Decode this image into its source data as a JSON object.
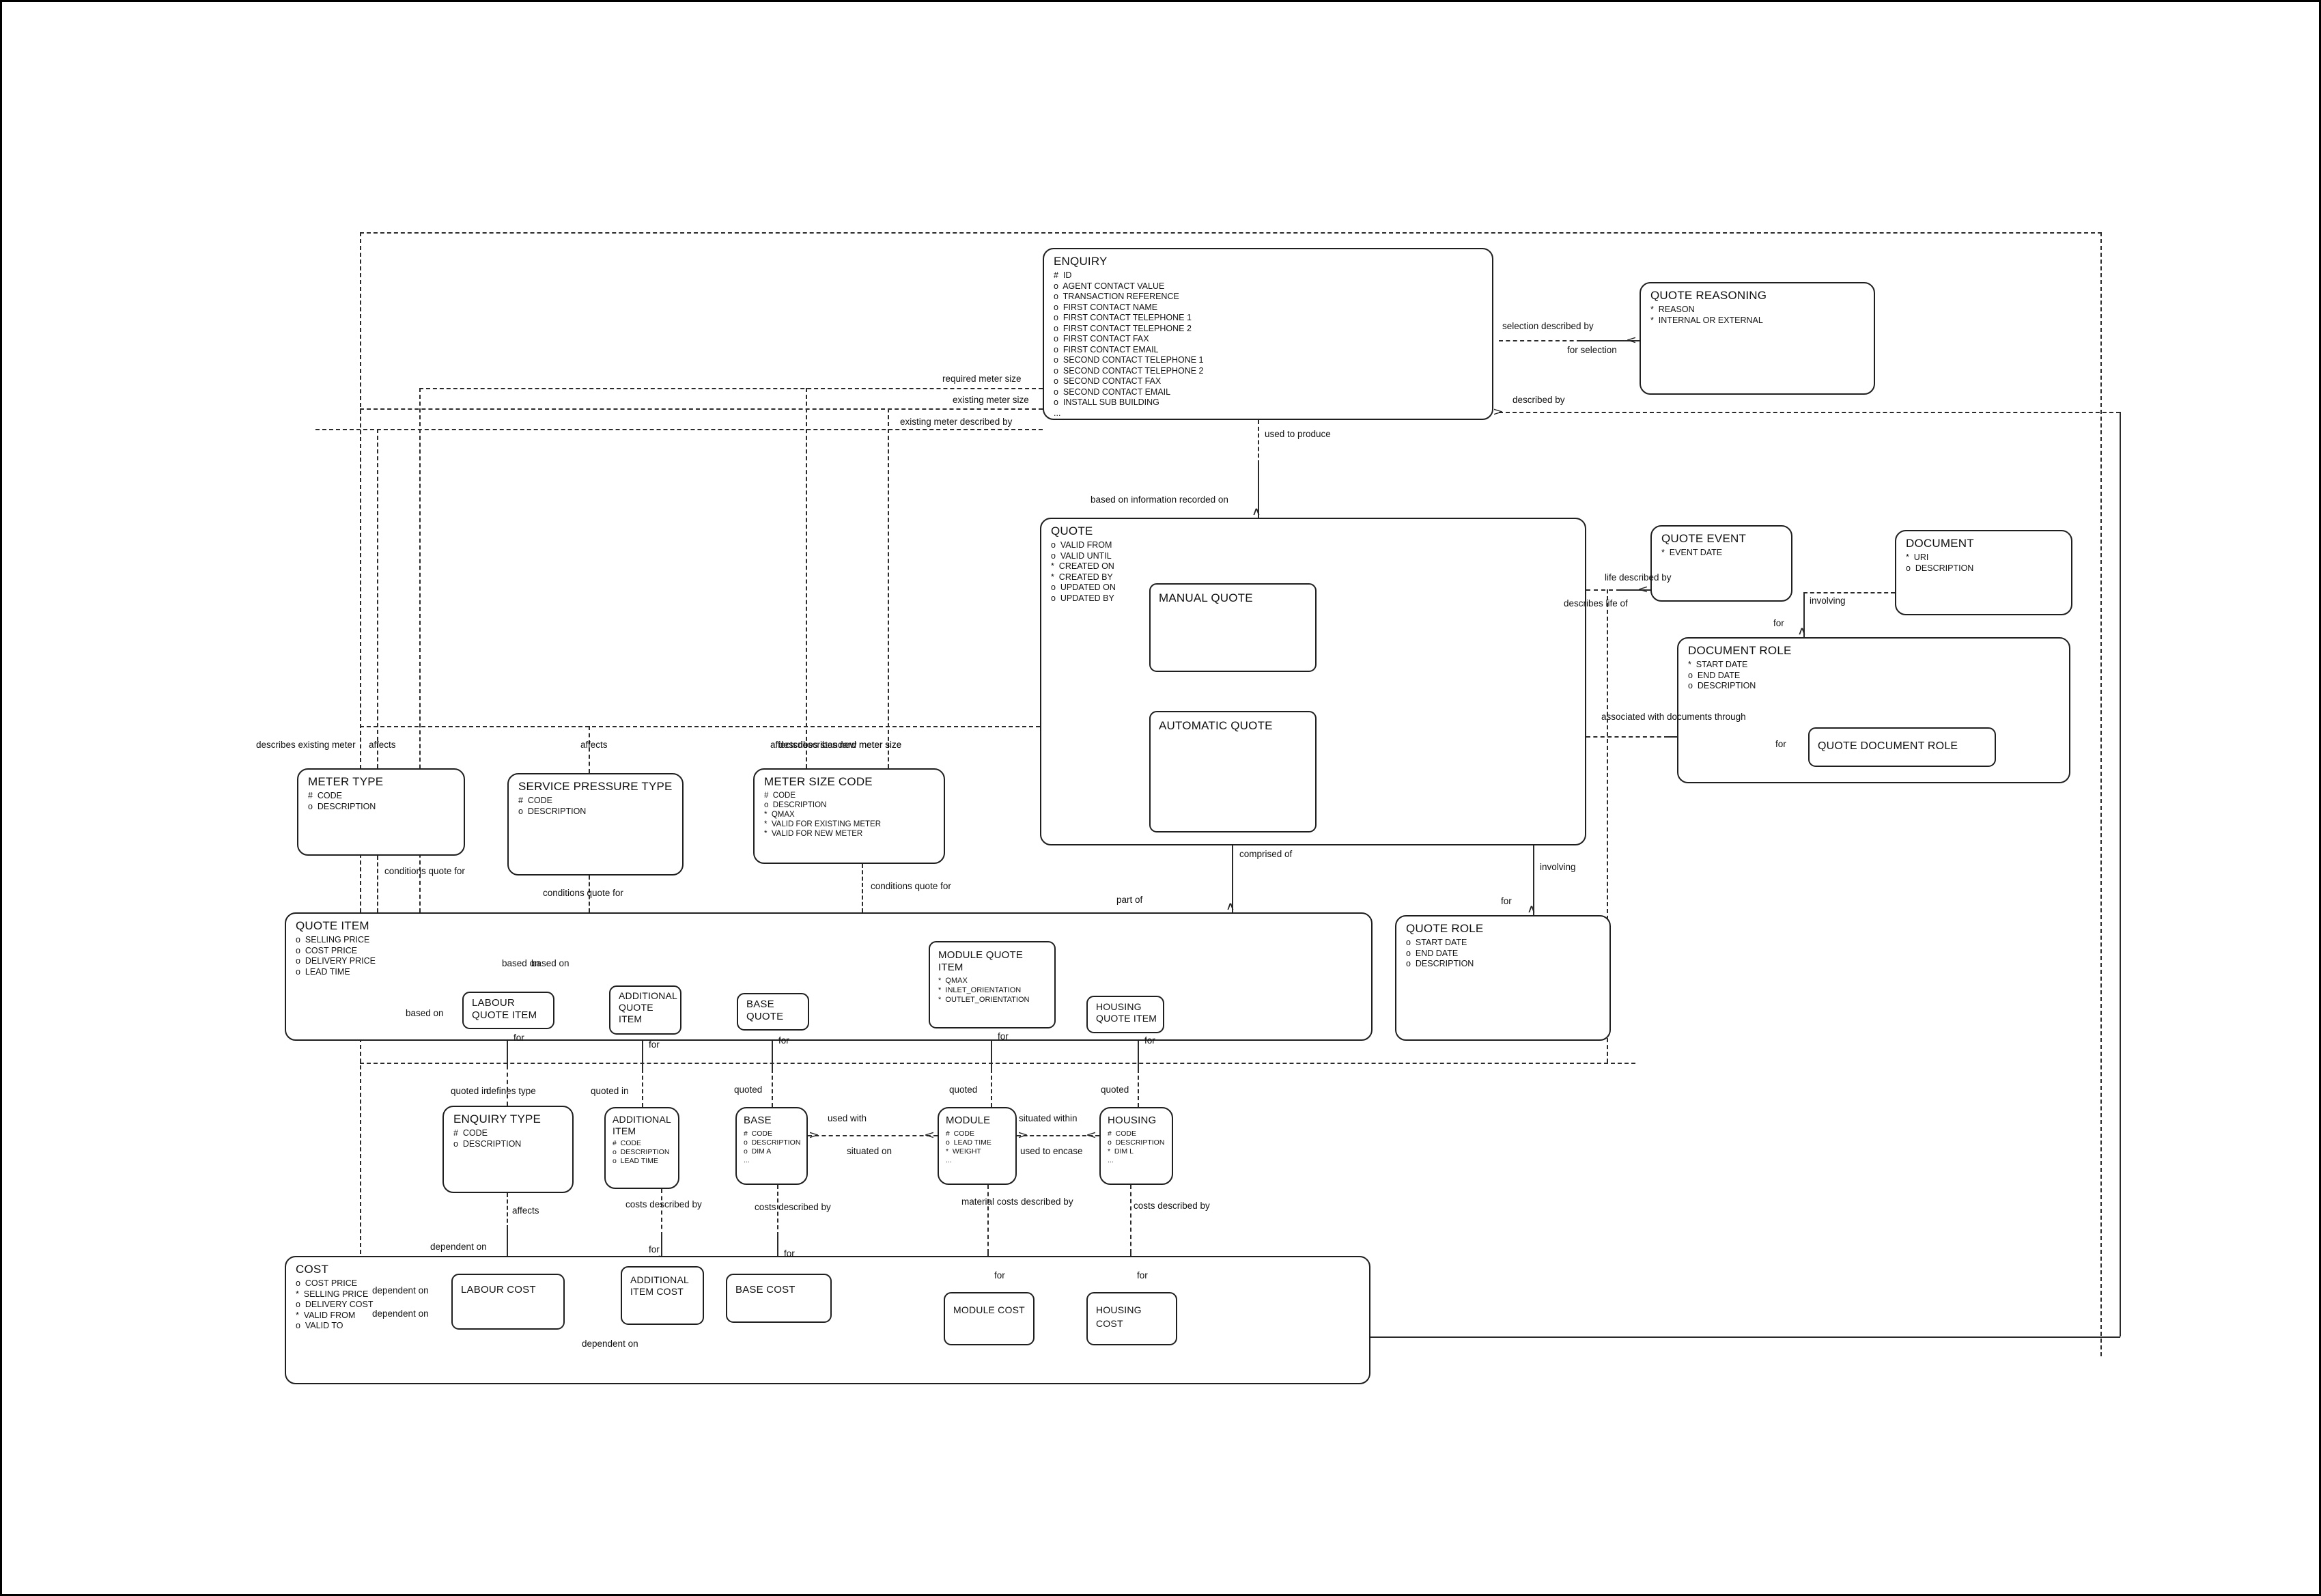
{
  "entities": {
    "enquiry": {
      "title": "ENQUIRY",
      "attrs": [
        "#  ID",
        "o  AGENT CONTACT VALUE",
        "o  TRANSACTION REFERENCE",
        "o  FIRST CONTACT NAME",
        "o  FIRST CONTACT TELEPHONE 1",
        "o  FIRST CONTACT TELEPHONE 2",
        "o  FIRST CONTACT FAX",
        "o  FIRST CONTACT EMAIL",
        "o  SECOND CONTACT TELEPHONE 1",
        "o  SECOND CONTACT TELEPHONE 2",
        "o  SECOND CONTACT FAX",
        "o  SECOND CONTACT EMAIL",
        "o  INSTALL SUB BUILDING",
        "..."
      ]
    },
    "quote_reasoning": {
      "title": "QUOTE REASONING",
      "attrs": [
        "*  REASON",
        "*  INTERNAL OR EXTERNAL"
      ]
    },
    "quote": {
      "title": "QUOTE",
      "attrs": [
        "o  VALID FROM",
        "o  VALID UNTIL",
        "*  CREATED ON",
        "*  CREATED BY",
        "o  UPDATED ON",
        "o  UPDATED BY"
      ]
    },
    "manual_quote": {
      "title": "MANUAL QUOTE",
      "attrs": []
    },
    "automatic_quote": {
      "title": "AUTOMATIC QUOTE",
      "attrs": []
    },
    "quote_event": {
      "title": "QUOTE EVENT",
      "attrs": [
        "*  EVENT DATE"
      ]
    },
    "document": {
      "title": "DOCUMENT",
      "attrs": [
        "*  URI",
        "o  DESCRIPTION"
      ]
    },
    "document_role": {
      "title": "DOCUMENT ROLE",
      "attrs": [
        "*  START DATE",
        "o  END DATE",
        "o  DESCRIPTION"
      ]
    },
    "quote_document_role": {
      "title": "QUOTE DOCUMENT ROLE",
      "attrs": []
    },
    "meter_type": {
      "title": "METER TYPE",
      "attrs": [
        "#  CODE",
        "o  DESCRIPTION"
      ]
    },
    "service_pressure_type": {
      "title": "SERVICE PRESSURE TYPE",
      "attrs": [
        "#  CODE",
        "o  DESCRIPTION"
      ]
    },
    "meter_size_code": {
      "title": "METER SIZE CODE",
      "attrs": [
        "#  CODE",
        "o  DESCRIPTION",
        "*  QMAX",
        "*  VALID FOR EXISTING METER",
        "*  VALID FOR NEW METER"
      ]
    },
    "quote_item": {
      "title": "QUOTE ITEM",
      "attrs": [
        "o  SELLING PRICE",
        "o  COST PRICE",
        "o  DELIVERY PRICE",
        "o  LEAD TIME"
      ]
    },
    "labour_quote_item": {
      "title": "LABOUR QUOTE ITEM",
      "attrs": []
    },
    "additional_quote_item": {
      "title": "ADDITIONAL QUOTE ITEM",
      "attrs": []
    },
    "base_quote": {
      "title": "BASE QUOTE",
      "attrs": []
    },
    "module_quote_item": {
      "title": "MODULE QUOTE ITEM",
      "attrs": [
        "*  QMAX",
        "*  INLET_ORIENTATION",
        "*  OUTLET_ORIENTATION"
      ]
    },
    "housing_quote_item": {
      "title": "HOUSING QUOTE ITEM",
      "attrs": []
    },
    "quote_role": {
      "title": "QUOTE ROLE",
      "attrs": [
        "o  START DATE",
        "o  END DATE",
        "o  DESCRIPTION"
      ]
    },
    "enquiry_type": {
      "title": "ENQUIRY TYPE",
      "attrs": [
        "#  CODE",
        "o  DESCRIPTION"
      ]
    },
    "additional_item": {
      "title": "ADDITIONAL ITEM",
      "attrs": [
        "#  CODE",
        "o  DESCRIPTION",
        "o  LEAD TIME"
      ]
    },
    "base": {
      "title": "BASE",
      "attrs": [
        "#  CODE",
        "o  DESCRIPTION",
        "o  DIM A",
        "..."
      ]
    },
    "module": {
      "title": "MODULE",
      "attrs": [
        "#  CODE",
        "o  LEAD TIME",
        "*  WEIGHT",
        "..."
      ]
    },
    "housing": {
      "title": "HOUSING",
      "attrs": [
        "#  CODE",
        "o  DESCRIPTION",
        "*  DIM L",
        "..."
      ]
    },
    "cost": {
      "title": "COST",
      "attrs": [
        "o  COST PRICE",
        "*  SELLING PRICE",
        "o  DELIVERY COST",
        "*  VALID FROM",
        "o  VALID TO"
      ]
    },
    "labour_cost": {
      "title": "LABOUR COST",
      "attrs": []
    },
    "additional_item_cost": {
      "title": "ADDITIONAL ITEM COST",
      "attrs": []
    },
    "base_cost": {
      "title": "BASE COST",
      "attrs": []
    },
    "module_cost": {
      "title": "MODULE COST",
      "attrs": []
    },
    "housing_cost": {
      "title": "HOUSING COST",
      "attrs": []
    }
  },
  "labels": {
    "selection_described_by": "selection described by",
    "for_selection": "for selection",
    "described_by": "described by",
    "required_meter_size": "required meter size",
    "existing_meter_size": "existing meter size",
    "existing_meter_described_by": "existing meter described by",
    "used_to_produce": "used to produce",
    "based_on_information_recorded_on": "based on information recorded on",
    "life_described_by": "life described by",
    "describes_life_of": "describes life of",
    "involving": "involving",
    "for": "for",
    "associated_with_documents_through": "associated with documents through",
    "comprised_of": "comprised of",
    "part_of": "part of",
    "describes_existing_meter": "describes existing meter",
    "affects": "affects",
    "describes_standard_meter_size": "describes standard meter size",
    "describes_new_meter_size": "describes new meter size",
    "conditions_quote_for": "conditions quote for",
    "based_on": "based on",
    "quoted_in": "quoted in",
    "defines_type": "defines type",
    "quoted": "quoted",
    "used_with": "used with",
    "situated_on": "situated on",
    "situated_within": "situated within",
    "used_to_encase": "used to encase",
    "costs_described_by": "costs described by",
    "material_costs_described_by": "material costs described by",
    "dependent_on": "dependent on"
  },
  "icons": {
    "crowfoot_up": "∧",
    "crowfoot_down": "∨",
    "crowfoot_left": "<",
    "crowfoot_right": ">"
  },
  "colors": {
    "line": "#2a2a2a",
    "background": "#ffffff",
    "text": "#111111"
  }
}
